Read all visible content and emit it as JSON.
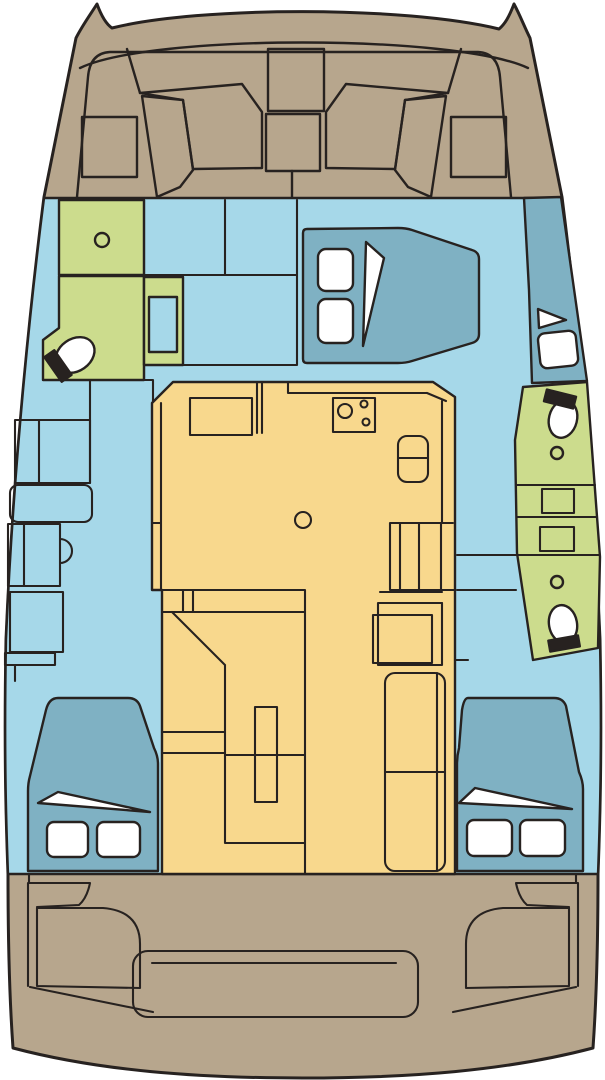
{
  "image_type": "catamaran-deck-floor-plan",
  "orientation": "bow-at-top",
  "palette": {
    "page_background": "#ffffff",
    "deck": "#b7a68d",
    "interior": "#a6d8e9",
    "berth": "#7fb1c3",
    "wet_area": "#ccdc8d",
    "saloon": "#f8d88d",
    "fixture": "#ffffff",
    "outline": "#272220"
  },
  "legend": {
    "deck": "exterior deck / cockpit",
    "interior": "interior cabin sole",
    "berth": "berths and moulded steps",
    "wet_area": "heads / wet areas",
    "saloon": "saloon, galley and dinette",
    "fixture": "pillows, hatches, sanitary fixtures"
  },
  "areas": [
    {
      "id": "foredeck",
      "fill_key": "deck"
    },
    {
      "id": "trampoline-panels",
      "fill_key": "deck"
    },
    {
      "id": "main-interior",
      "fill_key": "interior"
    },
    {
      "id": "port-forward-head",
      "fill_key": "wet_area"
    },
    {
      "id": "owner-forward-berth",
      "fill_key": "berth"
    },
    {
      "id": "starboard-entry-steps",
      "fill_key": "berth"
    },
    {
      "id": "starboard-heads",
      "fill_key": "wet_area"
    },
    {
      "id": "saloon-galley-dinette",
      "fill_key": "saloon"
    },
    {
      "id": "port-aft-berth",
      "fill_key": "berth"
    },
    {
      "id": "starboard-aft-berth",
      "fill_key": "berth"
    },
    {
      "id": "aft-cockpit",
      "fill_key": "deck"
    }
  ]
}
